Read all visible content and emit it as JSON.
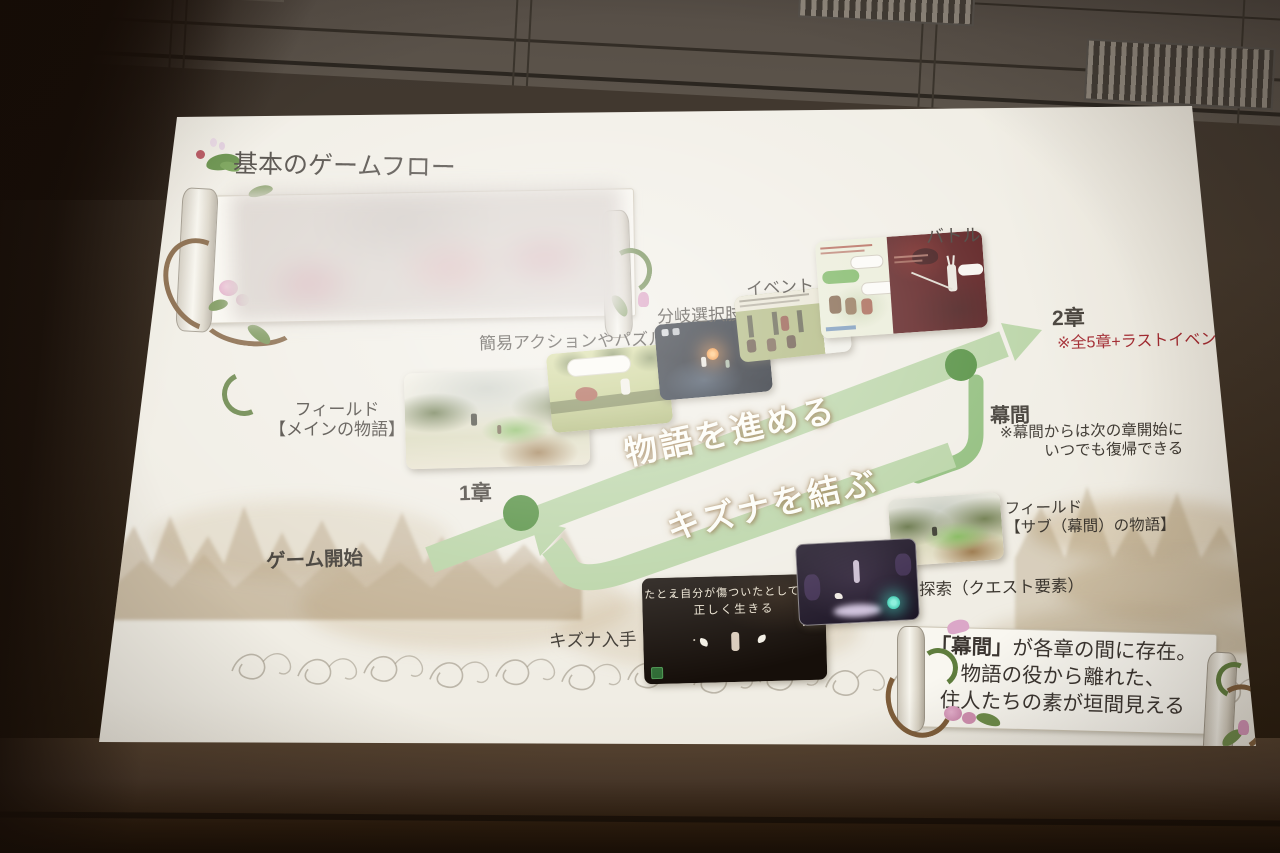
{
  "slide": {
    "title": "基本のゲームフロー",
    "flow": {
      "start": "ゲーム開始",
      "chapter1": "1章",
      "chapter2": "2章",
      "chapter2_note": "※全5章+ラストイベント",
      "interlude": "幕間",
      "interlude_note1": "※幕間からは次の章開始に",
      "interlude_note2": "いつでも復帰できる",
      "advance": "物語を進める",
      "bond": "キズナを結ぶ"
    },
    "labels": {
      "field_main1": "フィールド",
      "field_main2": "【メインの物語】",
      "action": "簡易アクションやパズル",
      "branch": "分岐選択肢",
      "event": "イベント",
      "battle": "バトル",
      "field_sub1": "フィールド",
      "field_sub2": "【サブ（幕間）の物語】",
      "explore": "探索（クエスト要素）",
      "kizuna": "キズナ入手"
    },
    "kizuna_screen": {
      "line1": "たとえ自分が傷ついたとしても、",
      "line2": "正しく生きる"
    },
    "banner": {
      "line1_bold": "「幕間」",
      "line1_rest": "が各章の間に存在。",
      "line2": "物語の役から離れた、",
      "line3": "住人たちの素が垣間見える"
    },
    "colors": {
      "band_green": "#b6d2a2",
      "loop_green": "#8cbb77",
      "node_green": "#4b8a37",
      "note_red": "#a1242c",
      "text_dark": "#3b362f",
      "slide_bg": "#f0ede4"
    }
  }
}
